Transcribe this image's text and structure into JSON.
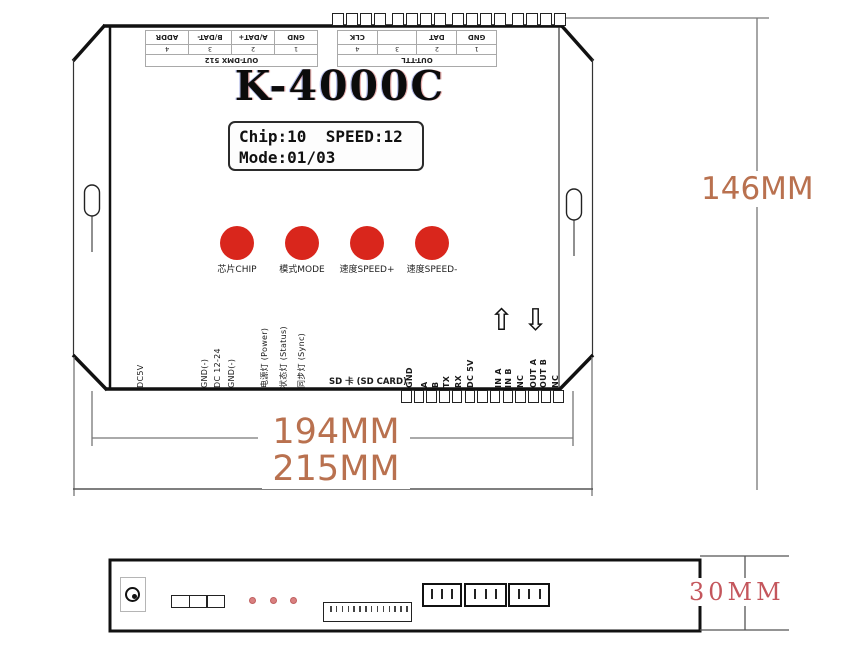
{
  "device": {
    "model": "K-4000C",
    "display": {
      "line1": "Chip:10  SPEED:12",
      "line2": "Mode:01/03"
    },
    "buttons": [
      {
        "label": "芯片CHIP"
      },
      {
        "label": "模式MODE"
      },
      {
        "label": "速度SPEED+"
      },
      {
        "label": "速度SPEED-"
      }
    ],
    "top_ports": {
      "dmx": {
        "name": "OUT-DMX 512",
        "pins": [
          {
            "num": "1",
            "label": "GND"
          },
          {
            "num": "2",
            "label": "A/DAT+"
          },
          {
            "num": "3",
            "label": "B/DAT-"
          },
          {
            "num": "4",
            "label": "ADDR"
          }
        ]
      },
      "ttl": {
        "name": "OUT-TTL",
        "pins": [
          {
            "num": "1",
            "label": "GND"
          },
          {
            "num": "2",
            "label": "DAT"
          },
          {
            "num": "3",
            "label": ""
          },
          {
            "num": "4",
            "label": "CLK"
          }
        ]
      }
    },
    "bottom_left_pins": [
      "DC5V",
      "GND(-)",
      "DC 12-24",
      "GND(-)"
    ],
    "indicator_labels": [
      "电源灯 (Power)",
      "状态灯 (Status)",
      "同步灯 (Sync)"
    ],
    "sd_slot_label": "SD 卡 (SD CARD)",
    "bottom_right_pins": [
      "GND",
      "A",
      "B",
      "TX",
      "RX",
      "DC 5V"
    ],
    "io_pins": [
      "IN A",
      "IN B",
      "NC",
      "OUT A",
      "OUT B",
      "NC"
    ],
    "arrows": {
      "up": "⇧",
      "down": "⇩"
    },
    "teeth": {
      "top_groups": 4,
      "teeth_per_group": 4,
      "bottom_count": 13
    }
  },
  "dimensions": {
    "height_label": "146MM",
    "mount_width_label": "194MM",
    "total_width_label": "215MM",
    "depth_label": "30MM"
  },
  "colors": {
    "button_red": "#d9261c",
    "dimension_brown": "#b9714f",
    "dimension_red": "#c4565c",
    "led_pink": "#d98080"
  }
}
